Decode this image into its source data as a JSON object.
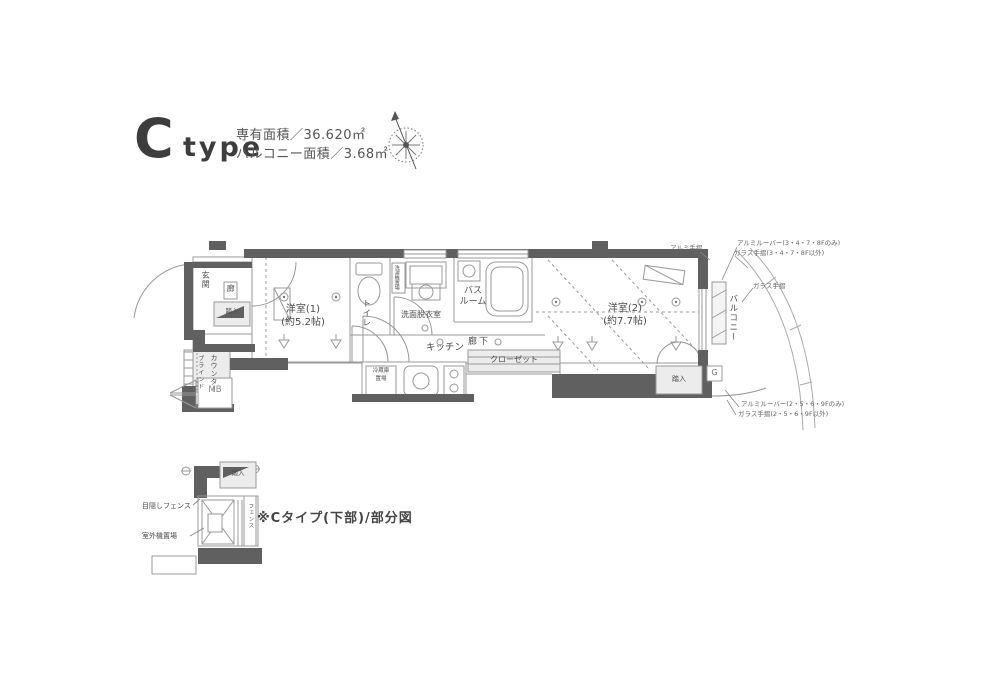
{
  "header": {
    "type_letter": "C",
    "type_word": "type",
    "exclusive_area": "専有面積／36.620㎡",
    "balcony_area": "バルコニー面積／3.68㎡"
  },
  "icons": {
    "compass": "compass-rose-icon"
  },
  "plan": {
    "entrance": "玄関",
    "hall_kanji": "廊",
    "entry_step": "踏入",
    "counter": "カウンター",
    "blind": "ブラインド",
    "meter_box": "MB",
    "room1": "洋室(1)",
    "room1_size": "(約5.2帖)",
    "toilet": "トイレ",
    "laundry": "洗濯機置場",
    "washroom": "洗面脱衣室",
    "bath_line1": "バス",
    "bath_line2": "ルーム",
    "kitchen": "キッチン",
    "fridge_line1": "冷蔵庫",
    "fridge_line2": "置場",
    "hallway": "廊下",
    "closet": "クローゼット",
    "room2": "洋室(2)",
    "room2_size": "(約7.7帖)",
    "entry_step2": "踏入",
    "balcony": "バルコニー",
    "gas_meter": "G"
  },
  "annotations": {
    "aluminum_rail": "アルミ手摺",
    "louver_top": "アルミルーバー(3・4・7・8Fのみ)",
    "glass_rail_top": "ガラス手摺(3・4・7・8F以外)",
    "glass_rail": "ガラス手摺",
    "louver_bottom": "アルミルーバー(2・5・6・9Fのみ)",
    "glass_rail_bottom": "ガラス手摺(2・5・6・9F以外)"
  },
  "partial_diagram": {
    "entry_step": "踏入",
    "privacy_fence": "目隠しフェンス",
    "outdoor_unit": "室外機置場",
    "fence_strip": "フェンス",
    "caption": "※Cタイプ(下部)/部分図"
  },
  "colors": {
    "wall": "#606060",
    "line": "#999999",
    "fill_light": "#ececec",
    "text": "#4c4c4c"
  }
}
